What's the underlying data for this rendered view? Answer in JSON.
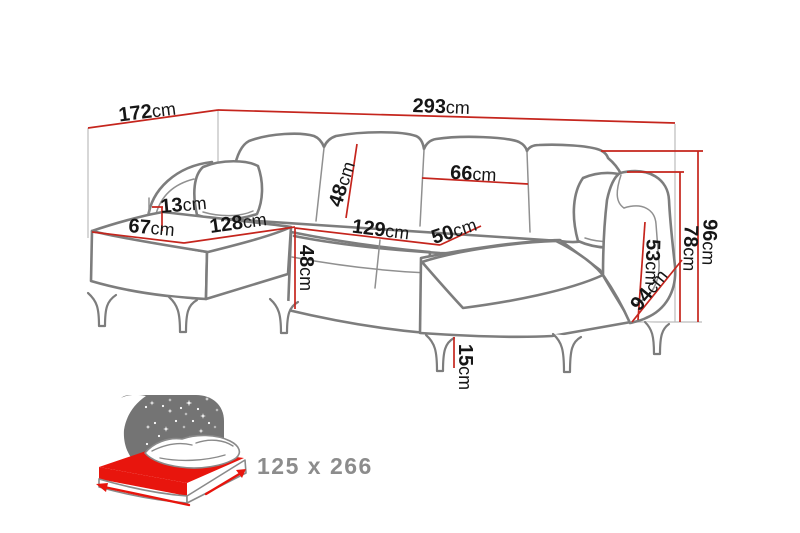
{
  "diagram": {
    "type": "sofa-dimension-diagram",
    "labels": {
      "total_depth": {
        "value": "172",
        "unit": "cm"
      },
      "total_width": {
        "value": "293",
        "unit": "cm"
      },
      "pillow_height": {
        "value": "13",
        "unit": "cm"
      },
      "chaise_width": {
        "value": "67",
        "unit": "cm"
      },
      "chaise_length": {
        "value": "128",
        "unit": "cm"
      },
      "back_cushion_height": {
        "value": "48",
        "unit": "cm"
      },
      "back_cushion_width": {
        "value": "66",
        "unit": "cm"
      },
      "seat_length": {
        "value": "129",
        "unit": "cm"
      },
      "seat_depth": {
        "value": "50",
        "unit": "cm"
      },
      "seat_height": {
        "value": "48",
        "unit": "cm"
      },
      "armrest_height": {
        "value": "53",
        "unit": "cm"
      },
      "chaise_depth": {
        "value": "94",
        "unit": "cm"
      },
      "back_height": {
        "value": "78",
        "unit": "cm"
      },
      "total_height": {
        "value": "96",
        "unit": "cm"
      },
      "leg_height": {
        "value": "15",
        "unit": "cm"
      }
    },
    "sleeping_area": "125 x 266",
    "colors": {
      "dimension_line": "#c5251d",
      "sofa_outline": "#7d7d7d",
      "guide_line": "#bcbcbc",
      "label_text": "#161616",
      "bed_icon_gray": "#747474",
      "bed_mattress_red": "#e8150d",
      "sleeping_area_text": "#8c8c8c"
    }
  }
}
